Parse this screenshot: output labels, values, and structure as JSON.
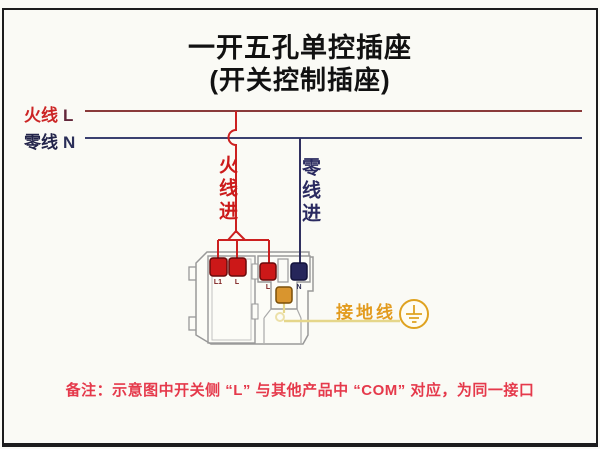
{
  "title": {
    "line1": "一开五孔单控插座",
    "line2": "(开关控制插座)"
  },
  "wires": {
    "live_label": "火线",
    "live_letter": "L",
    "neutral_label": "零线",
    "neutral_letter": "N",
    "live_in_label": "火线进",
    "neutral_in_label": "零线进",
    "ground_label": "接地线"
  },
  "device": {
    "terminals": [
      {
        "id": "switch-L1",
        "label": "L1",
        "color": "#cc1818"
      },
      {
        "id": "switch-L",
        "label": "L",
        "color": "#cc1818"
      },
      {
        "id": "socket-L",
        "label": "L",
        "color": "#cc1818"
      },
      {
        "id": "socket-N",
        "label": "N",
        "color": "#26265a"
      },
      {
        "id": "socket-E",
        "label": "",
        "color": "#d9952e"
      }
    ]
  },
  "note": "备注：示意图中开关侧 “L” 与其他产品中 “COM” 对应，为同一接口",
  "colors": {
    "live_red": "#cc2020",
    "live_line": "#8a3a3a",
    "neutral_navy": "#2f3366",
    "ground_gold": "#dfa21f",
    "ground_wire": "#e5d68a",
    "terminal_red": "#cc1818",
    "terminal_blue": "#26265a",
    "terminal_orange": "#d9952e",
    "note_red": "#e5394b",
    "outline_gray": "#999999",
    "frame_black": "#1c1c1c"
  }
}
